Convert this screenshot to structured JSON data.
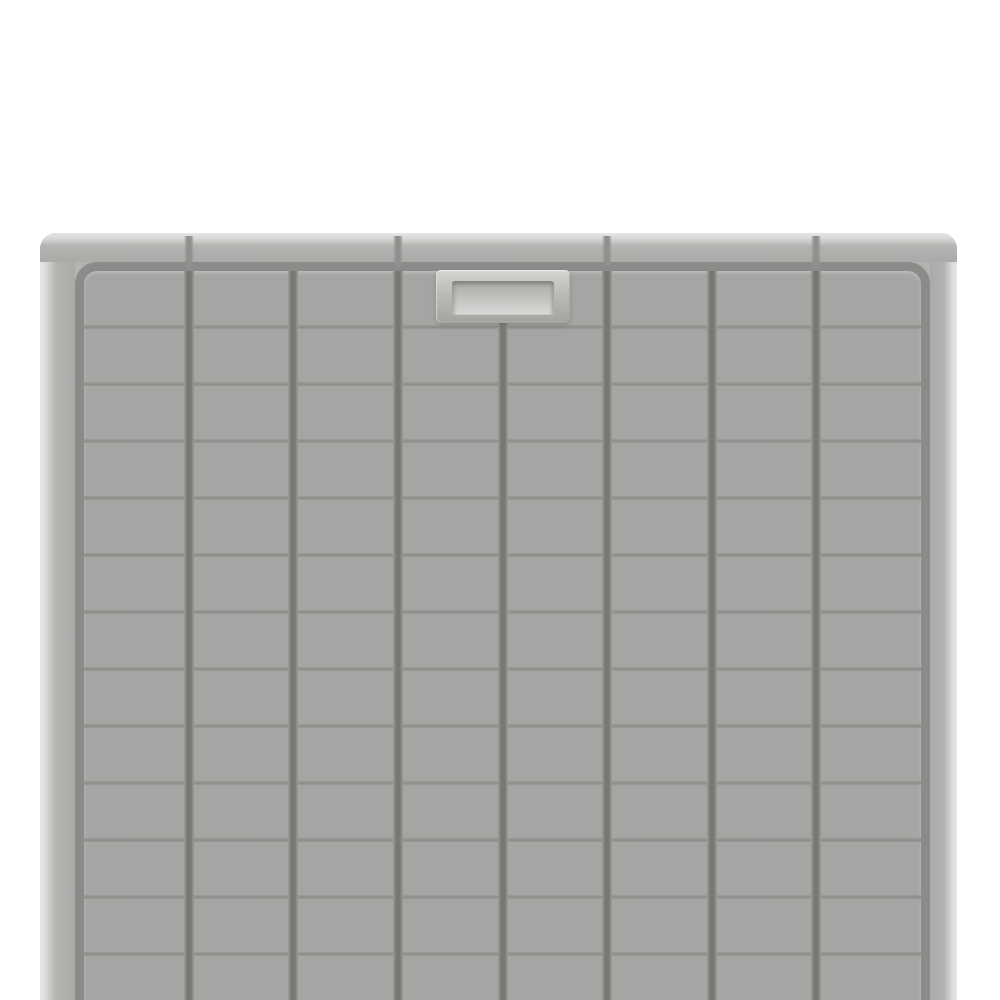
{
  "scene": {
    "description": "Product photograph of a light gray molded plastic grid tray (utility mat) on a plain white background, viewed straight on; the tray is cropped by the bottom edge of the image",
    "background_color": "#ffffff"
  },
  "tray": {
    "colors": {
      "background": "#ffffff",
      "rim_base": "#b2b4b1",
      "bevel_light": "#e4e6e3",
      "wall_light": "#d9dbd8",
      "wall_shade": "#a9aba8",
      "field": "#a4a6a3",
      "perimeter_groove": "#8a8c89",
      "groove_dark": "#767874",
      "groove_edge": "#9b9d9a",
      "row_line": "#8b8d8a",
      "notch": "#8f918e",
      "badge_face": "#bcbeb9",
      "badge_light": "#d3d5d2",
      "badge_dark": "#a2a4a1",
      "recess_face": "#c2c4c1",
      "recess_shade": "#a8aaa7",
      "recess_light": "#d8dad7"
    },
    "geometry": {
      "left": 40,
      "top": 233,
      "width": 917,
      "height": 767,
      "wall_left_width": 35,
      "wall_right_width": 27,
      "top_rim_height": 29,
      "perimeter_groove_width": 9
    },
    "grid": {
      "columns": 8,
      "vertical_groove_width": 10,
      "row_line_first_y": 56,
      "row_line_pitch": 57,
      "row_line_count": 12,
      "row_line_height": 4,
      "interrupted_groove_index": 4
    },
    "notches": {
      "at_groove_indices": [
        1,
        3,
        5,
        7
      ],
      "width": 10,
      "top": 3,
      "height": 31
    },
    "badge": {
      "centered_on_groove": 4,
      "width": 134,
      "height": 53,
      "top": 37,
      "recess_inset_x": 16,
      "recess_inset_top": 11,
      "recess_inset_bottom": 8
    }
  }
}
